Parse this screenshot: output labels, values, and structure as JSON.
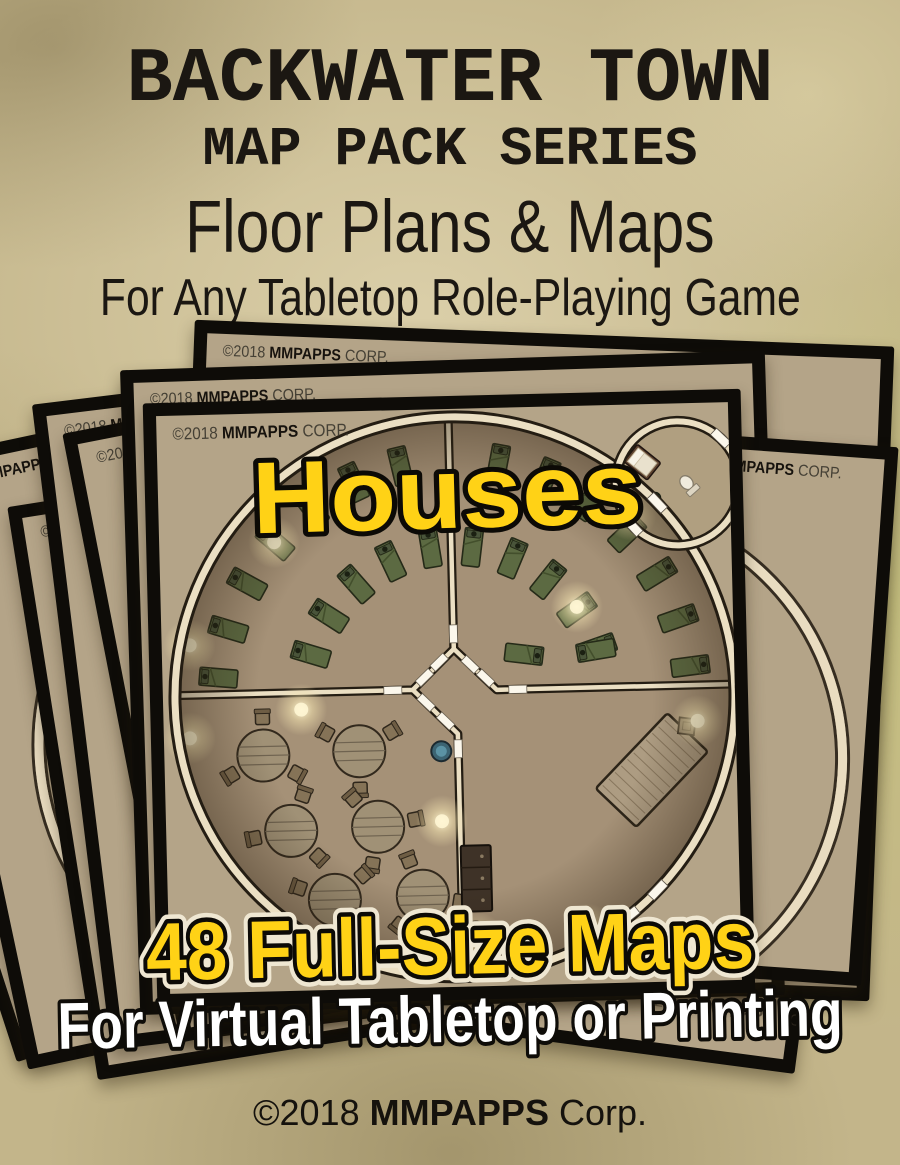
{
  "header": {
    "title": "BACKWATER TOWN",
    "series": "MAP PACK SERIES",
    "subtitle": "Floor Plans & Maps",
    "tagline": "For Any Tabletop Role-Playing Game"
  },
  "cards": {
    "copyright_prefix": "©2018 ",
    "copyright_brand": "MMPAPPS",
    "copyright_suffix": " CORP."
  },
  "overlays": {
    "map_label": "Houses",
    "count_label": "48 Full-Size Maps",
    "usage_label": "For Virtual Tabletop or Printing"
  },
  "footer": {
    "prefix": "©2018 ",
    "brand": "MMPAPPS",
    "suffix": " Corp."
  },
  "colors": {
    "parchment": "#c3b58a",
    "card_tan": "#b4a488",
    "frame_black": "#0e0c08",
    "accent_yellow": "#ffd216",
    "outline_black": "#0c0a06",
    "halo_cream": "#efe7d2",
    "white": "#ffffff",
    "wall_cream": "#ebdfc3",
    "wall_dark": "#241d13",
    "map_floor": "#a59177",
    "annex_floor": "#b09f80",
    "bed_green": "#5c6a42",
    "table_wood": "#a09176",
    "text_black": "#1b1712"
  },
  "map_features": {
    "beds": [
      [
        56,
        263,
        186
      ],
      [
        67,
        215,
        198
      ],
      [
        87,
        170,
        210
      ],
      [
        116,
        129,
        222
      ],
      [
        153,
        96,
        234
      ],
      [
        196,
        71,
        246
      ],
      [
        243,
        56,
        258
      ],
      [
        149,
        242,
        198
      ],
      [
        168,
        204,
        214
      ],
      [
        196,
        173,
        230
      ],
      [
        231,
        151,
        246
      ],
      [
        271,
        139,
        262
      ],
      [
        341,
        56,
        282
      ],
      [
        388,
        71,
        294
      ],
      [
        431,
        96,
        306
      ],
      [
        468,
        129,
        318
      ],
      [
        497,
        170,
        330
      ],
      [
        517,
        215,
        342
      ],
      [
        528,
        263,
        354
      ],
      [
        313,
        139,
        278
      ],
      [
        353,
        151,
        294
      ],
      [
        388,
        173,
        310
      ],
      [
        416,
        204,
        326
      ],
      [
        435,
        242,
        342
      ],
      [
        362,
        247,
        8
      ],
      [
        434,
        245,
        172
      ]
    ],
    "round_tables": [
      {
        "x": 99,
        "y": 342,
        "chairs": [
          150,
          270,
          30
        ]
      },
      {
        "x": 195,
        "y": 340,
        "chairs": [
          90,
          210,
          330
        ]
      },
      {
        "x": 125,
        "y": 418,
        "chairs": [
          45,
          170,
          290
        ]
      },
      {
        "x": 212,
        "y": 416,
        "chairs": [
          100,
          230,
          350
        ]
      },
      {
        "x": 167,
        "y": 488,
        "chairs": [
          70,
          200,
          320
        ]
      },
      {
        "x": 255,
        "y": 486,
        "chairs": [
          130,
          250,
          10
        ]
      }
    ],
    "big_table": {
      "x": 487,
      "y": 366,
      "rot": 45,
      "w": 56,
      "h": 104
    },
    "crate": {
      "x": 523,
      "y": 323,
      "s": 16
    },
    "cabinet": {
      "x": 309,
      "y": 470,
      "w": 30,
      "h": 66
    },
    "basin": {
      "x": 277,
      "y": 342,
      "r": 10
    },
    "pots": [
      [
        307,
        522
      ],
      [
        325,
        531
      ],
      [
        341,
        542
      ],
      [
        315,
        547
      ]
    ],
    "lights": [
      [
        115,
        129
      ],
      [
        28,
        230
      ],
      [
        416,
        201
      ],
      [
        138,
        297
      ],
      [
        276,
        412
      ],
      [
        534,
        318
      ],
      [
        420,
        524
      ],
      [
        309,
        530
      ],
      [
        472,
        110
      ],
      [
        26,
        323
      ]
    ],
    "annex": {
      "bed": {
        "x": 485,
        "y": 58,
        "rot": -50
      },
      "desk": {
        "x": 471,
        "y": 73,
        "rot": -50
      },
      "toilet": {
        "x": 530,
        "y": 81,
        "rot": 140
      },
      "plant": {
        "x": 497,
        "y": 94
      }
    }
  }
}
